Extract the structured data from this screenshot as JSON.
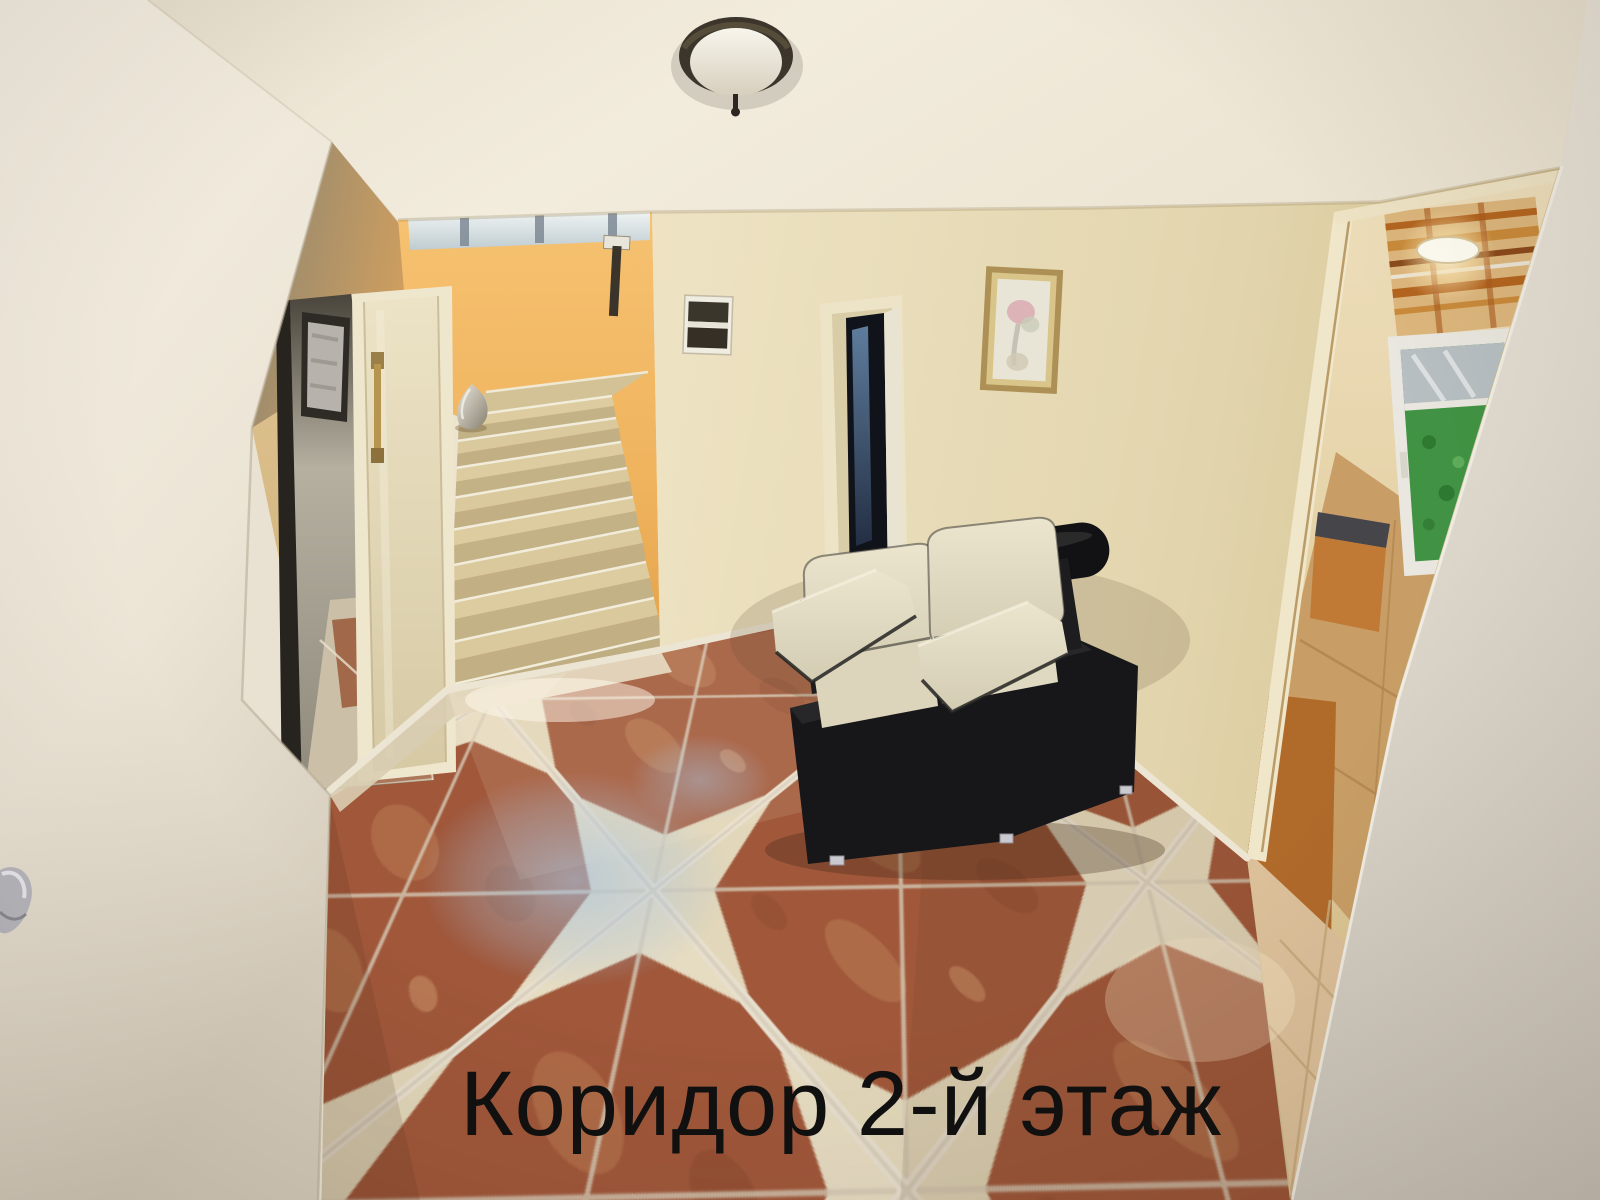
{
  "caption": {
    "text": "Коридор 2-й этаж"
  },
  "palette": {
    "caption-color": "#101010",
    "ceiling": "#f0e9d9",
    "wall-cream": "#e7dcba",
    "wall-shadow-olive": "#8d8671",
    "stairwell-orange": "#efb25c",
    "stair-tread": "#d9c99c",
    "terracotta-tile": "#a0573a",
    "cream-tile": "#e6dcc2",
    "sofa-leather-cream": "#e3dcc5",
    "sofa-leather-black": "#17171a",
    "bathroom-tan-tile": "#c89e66",
    "window-foliage": "#419344",
    "painting-frame-gold": "#ad9055"
  }
}
